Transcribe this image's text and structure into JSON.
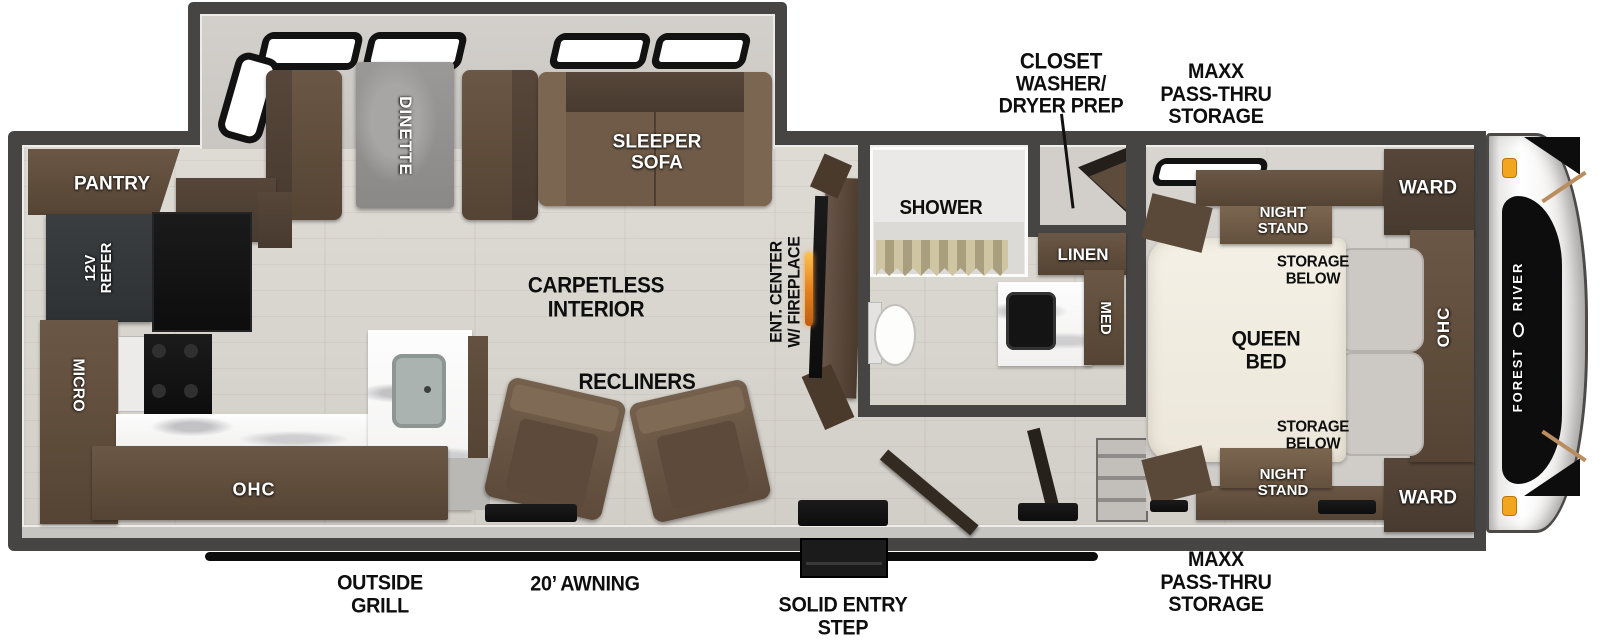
{
  "colors": {
    "wall": "#474543",
    "floor": "#d8d4ce",
    "furniture_brown": "#6b5745",
    "appliance_black": "#141414",
    "counter_white": "#fbfafa",
    "fireplace_orange": "#e8821e",
    "marker_light_orange": "#f2a51f",
    "label_black": "#0e0e0e",
    "label_white": "#ffffff"
  },
  "labels": {
    "exterior": {
      "closet": [
        "CLOSET",
        "WASHER/",
        "DRYER PREP"
      ],
      "maxx_top": [
        "MAXX",
        "PASS-THRU",
        "STORAGE"
      ],
      "maxx_bottom": [
        "MAXX",
        "PASS-THRU",
        "STORAGE"
      ],
      "outside_grill": [
        "OUTSIDE",
        "GRILL"
      ],
      "awning": "20’ AWNING",
      "entry_step": [
        "SOLID ENTRY",
        "STEP"
      ]
    },
    "kitchen": {
      "pantry": "PANTRY",
      "refer": [
        "12V",
        "REFER"
      ],
      "micro": "MICRO",
      "ohc": "OHC"
    },
    "living": {
      "dinette": "DINETTE",
      "sleeper_sofa": [
        "SLEEPER",
        "SOFA"
      ],
      "carpetless": [
        "CARPETLESS",
        "INTERIOR"
      ],
      "recliners": "RECLINERS",
      "ent_center": [
        "ENT. CENTER",
        "W/ FIREPLACE"
      ]
    },
    "bath": {
      "shower": "SHOWER",
      "linen": "LINEN",
      "med": "MED"
    },
    "bedroom": {
      "night_stand_top": [
        "NIGHT",
        "STAND"
      ],
      "storage_below_top": [
        "STORAGE",
        "BELOW"
      ],
      "queen_bed": [
        "QUEEN",
        "BED"
      ],
      "storage_below_bottom": [
        "STORAGE",
        "BELOW"
      ],
      "night_stand_bottom": [
        "NIGHT",
        "STAND"
      ],
      "ward_top": "WARD",
      "ward_bottom": "WARD",
      "ohc": "OHC"
    },
    "brand": {
      "word1": "FOREST",
      "word2": "RIVER"
    }
  }
}
